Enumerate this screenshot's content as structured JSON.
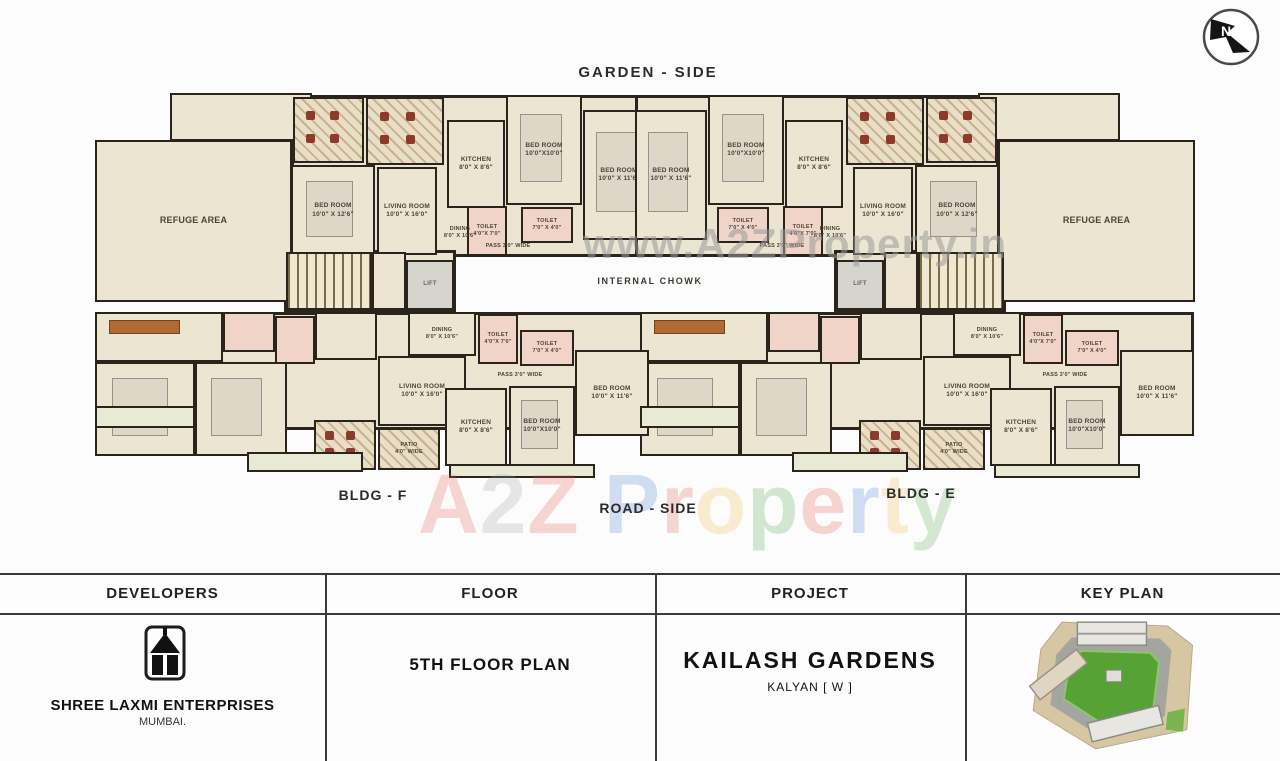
{
  "page": {
    "top_label": "GARDEN - SIDE",
    "internal_chowk_label": "INTERNAL CHOWK",
    "bldg_left_label": "BLDG  - F",
    "road_side_label": "ROAD - SIDE",
    "bldg_right_label": "BLDG  - E",
    "north_letter": "N"
  },
  "watermarks": {
    "center_url": "www.A2ZProperty.in",
    "brand_letters": [
      {
        "ch": "A",
        "color": "#e05a50"
      },
      {
        "ch": "2",
        "color": "#9aa0a6"
      },
      {
        "ch": "Z",
        "color": "#e05a50"
      },
      {
        "ch": " ",
        "color": ""
      },
      {
        "ch": "P",
        "color": "#4a7bd4"
      },
      {
        "ch": "r",
        "color": "#e2574c"
      },
      {
        "ch": "o",
        "color": "#f0b73a"
      },
      {
        "ch": "p",
        "color": "#4aa348"
      },
      {
        "ch": "e",
        "color": "#e0564c"
      },
      {
        "ch": "r",
        "color": "#4a7bd4"
      },
      {
        "ch": "t",
        "color": "#f0b73a"
      },
      {
        "ch": "y",
        "color": "#57a648"
      }
    ]
  },
  "plan": {
    "mirror_width": 1290,
    "bottom_flat_offset": 545,
    "rooms": [
      {
        "n": "building-slab-top",
        "f": "slab",
        "row": "top",
        "x": 291,
        "y": 95,
        "w": 364,
        "h": 162
      },
      {
        "n": "core-slab",
        "f": "slab",
        "row": "top",
        "x": 284,
        "y": 250,
        "w": 172,
        "h": 62
      },
      {
        "n": "building-slab-bottom",
        "f": "slab",
        "row": "bottom",
        "x": 95,
        "y": 312,
        "w": 554,
        "h": 118
      },
      {
        "n": "refuge-notch",
        "f": "beige",
        "row": "top",
        "x": 170,
        "y": 93,
        "w": 142,
        "h": 48
      },
      {
        "n": "refuge-area",
        "l": "REFUGE AREA",
        "f": "beige",
        "row": "top",
        "x": 95,
        "y": 140,
        "w": 197,
        "h": 162,
        "fs": 9
      },
      {
        "n": "patio-room",
        "f": "patioC",
        "row": "top",
        "x": 293,
        "y": 97,
        "w": 71,
        "h": 66
      },
      {
        "n": "patio-room",
        "f": "patioC",
        "row": "top",
        "x": 366,
        "y": 97,
        "w": 78,
        "h": 68
      },
      {
        "n": "bedroom",
        "l": "BED ROOM",
        "d": "10'0\" X 12'6\"",
        "f": "beige",
        "row": "top",
        "x": 291,
        "y": 165,
        "w": 84,
        "h": 91,
        "furn": "bed"
      },
      {
        "n": "living-room",
        "l": "LIVING ROOM",
        "d": "10'0\" X 16'0\"",
        "f": "beige",
        "row": "top",
        "x": 377,
        "y": 167,
        "w": 60,
        "h": 88
      },
      {
        "n": "kitchen",
        "l": "KITCHEN",
        "d": "8'0\" X 8'6\"",
        "f": "beige",
        "row": "top",
        "x": 447,
        "y": 120,
        "w": 58,
        "h": 88
      },
      {
        "n": "bedroom",
        "l": "BED ROOM",
        "d": "10'0\"X10'0\"",
        "f": "beige",
        "row": "top",
        "x": 506,
        "y": 95,
        "w": 76,
        "h": 110,
        "furn": "bed"
      },
      {
        "n": "bedroom",
        "l": "BED ROOM",
        "d": "10'0\" X 11'6\"",
        "f": "beige",
        "row": "top",
        "x": 583,
        "y": 110,
        "w": 72,
        "h": 130,
        "furn": "bed"
      },
      {
        "n": "passage",
        "l": "PASS 3'0\" WIDE",
        "f": "nob",
        "row": "top",
        "x": 448,
        "y": 240,
        "w": 120,
        "h": 14,
        "fs": 5.5
      },
      {
        "n": "toilet",
        "l": "TOILET",
        "d": "7'0\" X 4'0\"",
        "f": "pink",
        "row": "top",
        "x": 521,
        "y": 207,
        "w": 52,
        "h": 36,
        "fs": 5.5
      },
      {
        "n": "toilet",
        "l": "TOILET",
        "d": "4'0\"X 7'0\"",
        "f": "pink",
        "row": "top",
        "x": 467,
        "y": 206,
        "w": 40,
        "h": 50,
        "fs": 5.5
      },
      {
        "n": "dining",
        "l": "DINING",
        "d": "8'0\" X 10'6\"",
        "f": "nob",
        "row": "top",
        "x": 438,
        "y": 214,
        "w": 44,
        "h": 38,
        "fs": 5.5
      },
      {
        "n": "staircase",
        "f": "stairs",
        "row": "top",
        "x": 286,
        "y": 252,
        "w": 86,
        "h": 58
      },
      {
        "n": "lobby",
        "f": "beige",
        "row": "top",
        "x": 372,
        "y": 252,
        "w": 34,
        "h": 58
      },
      {
        "n": "lift",
        "l": "LIFT",
        "f": "lift",
        "row": "top",
        "x": 406,
        "y": 260,
        "w": 48,
        "h": 50,
        "fs": 6
      },
      {
        "n": "hall-room",
        "f": "beige",
        "row": "bottom",
        "x": 95,
        "y": 312,
        "w": 128,
        "h": 50,
        "furn": "wood"
      },
      {
        "n": "bedroom",
        "f": "beige",
        "row": "bottom",
        "x": 95,
        "y": 362,
        "w": 100,
        "h": 94,
        "furn": "bed"
      },
      {
        "n": "bedroom",
        "f": "beige",
        "row": "bottom",
        "x": 195,
        "y": 362,
        "w": 92,
        "h": 94,
        "furn": "bed"
      },
      {
        "n": "toilet",
        "f": "pink",
        "row": "bottom",
        "x": 223,
        "y": 312,
        "w": 52,
        "h": 40
      },
      {
        "n": "toilet",
        "f": "pink",
        "row": "bottom",
        "x": 275,
        "y": 316,
        "w": 40,
        "h": 48
      },
      {
        "n": "foyer",
        "f": "beige",
        "row": "bottom",
        "x": 315,
        "y": 312,
        "w": 62,
        "h": 48
      },
      {
        "n": "dining",
        "l": "DINING",
        "d": "8'0\" X 10'6\"",
        "f": "beige",
        "row": "bottom",
        "x": 408,
        "y": 312,
        "w": 68,
        "h": 44,
        "fs": 5.5
      },
      {
        "n": "living-room",
        "l": "LIVING ROOM",
        "d": "10'0\" X 16'0\"",
        "f": "beige",
        "row": "bottom",
        "x": 378,
        "y": 356,
        "w": 88,
        "h": 70
      },
      {
        "n": "toilet",
        "l": "TOILET",
        "d": "4'0\"X 7'0\"",
        "f": "pink",
        "row": "bottom",
        "x": 478,
        "y": 314,
        "w": 40,
        "h": 50,
        "fs": 5.5
      },
      {
        "n": "toilet",
        "l": "TOILET",
        "d": "7'0\" X 4'0\"",
        "f": "pink",
        "row": "bottom",
        "x": 520,
        "y": 330,
        "w": 54,
        "h": 36,
        "fs": 5.5
      },
      {
        "n": "passage",
        "l": "PASS 3'0\" WIDE",
        "f": "nob",
        "row": "bottom",
        "x": 468,
        "y": 368,
        "w": 104,
        "h": 16,
        "fs": 5.5
      },
      {
        "n": "kitchen",
        "l": "KITCHEN",
        "d": "8'0\" X 8'6\"",
        "f": "beige",
        "row": "bottom",
        "x": 445,
        "y": 388,
        "w": 62,
        "h": 78
      },
      {
        "n": "bedroom",
        "l": "BED ROOM",
        "d": "10'0\"X10'0\"",
        "f": "beige",
        "row": "bottom",
        "x": 509,
        "y": 386,
        "w": 66,
        "h": 80,
        "furn": "bed"
      },
      {
        "n": "bedroom",
        "l": "BED ROOM",
        "d": "10'0\" X 11'6\"",
        "f": "beige",
        "row": "bottom",
        "x": 575,
        "y": 350,
        "w": 74,
        "h": 86
      },
      {
        "n": "patio",
        "l": "PATIO",
        "d": "4'0\" WIDE",
        "f": "patio",
        "row": "bottom",
        "x": 378,
        "y": 428,
        "w": 62,
        "h": 42,
        "fs": 5.5
      },
      {
        "n": "patio-room",
        "f": "patioC",
        "row": "bottom",
        "x": 314,
        "y": 420,
        "w": 62,
        "h": 50
      },
      {
        "n": "balcony",
        "f": "light",
        "row": "bottom",
        "x": 95,
        "y": 406,
        "w": 100,
        "h": 22
      },
      {
        "n": "balcony",
        "f": "light",
        "row": "bottom",
        "x": 247,
        "y": 452,
        "w": 116,
        "h": 20
      },
      {
        "n": "balcony",
        "f": "light",
        "row": "bottom",
        "x": 449,
        "y": 464,
        "w": 146,
        "h": 14
      }
    ]
  },
  "table": {
    "headers": [
      "DEVELOPERS",
      "FLOOR",
      "PROJECT",
      "KEY PLAN"
    ],
    "developer": {
      "name": "SHREE LAXMI ENTERPRISES",
      "city": "MUMBAI."
    },
    "floor": "5TH FLOOR PLAN",
    "project": {
      "name": "KAILASH GARDENS",
      "location": "KALYAN [ W ]"
    }
  }
}
